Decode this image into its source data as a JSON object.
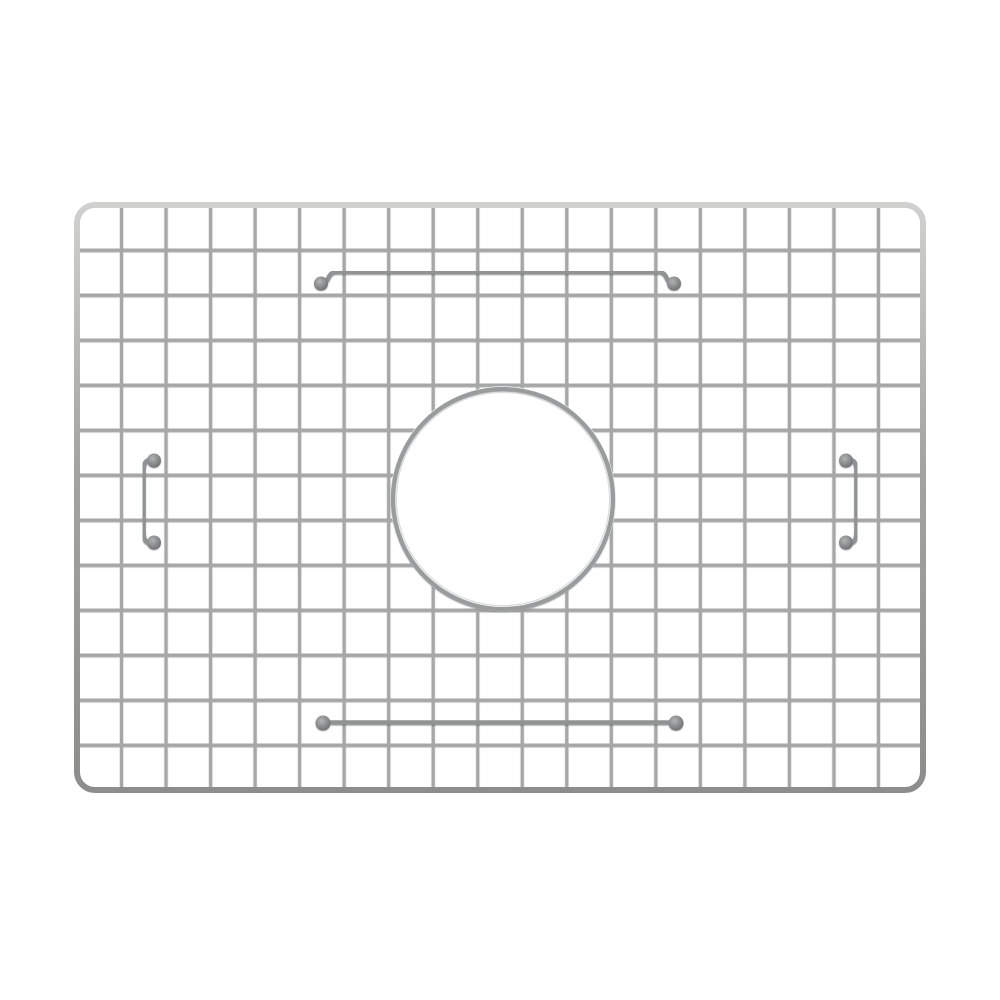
{
  "photo": {
    "subject": "stainless-steel-sink-bottom-grid",
    "canvas": {
      "width": 1000,
      "height": 1000,
      "background": "#ffffff"
    },
    "frame": {
      "x": 77,
      "y": 205,
      "width": 846,
      "height": 585,
      "corner_radius": 18,
      "stroke_width": 6
    },
    "mesh": {
      "columns": 19,
      "rows": 13,
      "wire_width": 3.1
    },
    "drain_opening": {
      "cx": 503,
      "cy": 499,
      "radius": 110,
      "ring_width": 4.2,
      "highlight_inset": 3.4,
      "highlight_width": 1.3
    },
    "top_support_bar": {
      "x1": 321,
      "x2": 674,
      "y": 272,
      "pad_y": 283.5,
      "pad_radius": 7,
      "stroke_width": 4.6
    },
    "bottom_support_bar": {
      "x1": 323,
      "x2": 676,
      "y": 722.5,
      "pad_radius": 7.5,
      "stroke_width": 4.6
    },
    "left_handle": {
      "bar_x": 143.5,
      "pad_x": 152.5,
      "top": 460.5,
      "bottom": 542.5,
      "pad_radius": 7,
      "stroke_width": 4.6
    },
    "right_handle": {
      "bar_x": 856.5,
      "pad_x": 847.5,
      "top": 460.5,
      "bottom": 542.5,
      "pad_radius": 7,
      "stroke_width": 4.6
    },
    "colors": {
      "background": "#ffffff",
      "wire": "#a6a8a7",
      "wire_edge_shadow": "rgba(45,45,45,0.45)",
      "frame_light": "#d0d1cf",
      "frame_mid": "#a3a4a2",
      "frame_dark": "#8d8e8c",
      "ring": "#989c9d",
      "ring_highlight": "#dcdedd",
      "accessory_wire": "#909394",
      "pad_light": "#b2b4b3",
      "pad_dark": "#686a6c"
    }
  }
}
